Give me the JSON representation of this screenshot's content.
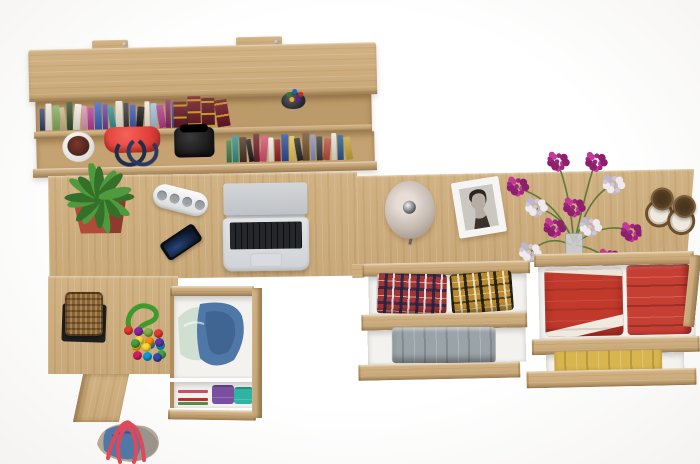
{
  "scene": {
    "type": "product-photo",
    "description": "Top-down view of a light-oak home office set: wall bookshelf with books and bags, corner desk with laptop, phone, plant and power strip, pedestal with open drawer of denim clothes, duffel bag, and a wide chest with four open drawers of folded clothes; lamp, portrait photo, flowers and candle lanterns on top",
    "background": "#fdfdfd"
  },
  "palette": {
    "bg": "#fdfdfd",
    "wood": "#cfae7d",
    "woodLight": "#e0c295",
    "woodDark": "#b08e5c",
    "woodDeep": "#8f6f43",
    "redBag": "#e04038",
    "black": "#161616",
    "pot": "#b14a38",
    "leafGreen": "#4e9a3c",
    "leafDark": "#35702a",
    "stripWhite": "#f2f3f4",
    "phoneBlue": "#27457c",
    "laptopSilver": "#e2e4e7",
    "keyBlack": "#1a1b1f",
    "lampShade": "#c6bab1",
    "frameWhite": "#f6f5f3",
    "flowerMagenta": "#a2247f",
    "flowerPale": "#cfc6d8",
    "stemGreen": "#5c7a3a",
    "candleWood": "#5f4527",
    "candleWax": "#efe9df",
    "plaidRed": "#a23535",
    "plaidYellow": "#b98a2e",
    "jeans": "#9aa3a8",
    "clothRed": "#c0392b",
    "clothRedStack": "#c63f33",
    "clothYellow": "#d8b54e",
    "denim": "#4f77a8",
    "denimDark": "#35577f",
    "mint": "#cfe0d2",
    "purpleShirt": "#7b4fa0",
    "tealShirt": "#2fb3a3",
    "basket": "#8a6335",
    "mat": "#1f1f1f",
    "toyGreen": "#3f9a2e",
    "strapRed": "#e0485a",
    "duffelTan": "#b7a995",
    "duffelGray": "#9a958c"
  },
  "wall_shelf": {
    "material": "light oak wall bookshelf with two mounting brackets",
    "upper_row_spines": [
      "#2e3f74",
      "#ece8dd",
      "#7fae5c",
      "#c8b48a",
      "#31502f",
      "#f0ecdf",
      "#d892b4",
      "#b23a9e",
      "#3a63b8",
      "#6a3f9e",
      "#2f8f8f",
      "#e9e4d8",
      "#353535",
      "#3e57ae",
      "#171717",
      "#efeadf",
      "#9fc0dc",
      "#b03a88",
      "#842a64",
      "#474a8e",
      "#ded6c4",
      "#232323"
    ],
    "encyclopedia_colors": [
      "#6b1822",
      "#731b26",
      "#641520",
      "#6e1722"
    ],
    "lower_row_spines": [
      "#3f7a4c",
      "#2f8f86",
      "#4a3322",
      "#1c1c1c",
      "#6e1d2c",
      "#d2506e",
      "#efeade",
      "#8c1f1f",
      "#2c4c96",
      "#e2c44e",
      "#262626",
      "#6e4e2c",
      "#8a8fb8",
      "#3a3a3a",
      "#b84a3a",
      "#e8e2d4",
      "#2a5a8a",
      "#c8a23a"
    ],
    "pencil_cup_pens": [
      "#2e7d32",
      "#1565c0",
      "#c62828",
      "#f9a825",
      "#6a1b9a"
    ],
    "lower_row_items": [
      "white plant bowl",
      "red handbag",
      "black camera bag",
      "books"
    ]
  },
  "desk": {
    "items": [
      "potted plant in terracotta cube",
      "white power strip",
      "smartphone",
      "open silver laptop"
    ],
    "laptop": {
      "wallpaper": "purple-pink aurora",
      "keys": "black chiclet",
      "trackpad": "silver"
    }
  },
  "pedestal": {
    "drawer_contents": "denim clothes with mint cloth",
    "shelf_contents": [
      "stacked magazines",
      "purple folded shirt",
      "teal folded shirt"
    ],
    "magazine_stripes": [
      "#d04a6a",
      "#f5f2ea",
      "#b83030",
      "#5a8a4a"
    ]
  },
  "accessories": {
    "basket": "wicker basket on black mat",
    "toy": "green rope toy with multicolor pom-poms",
    "toy_pom_colors": [
      "#e53935",
      "#fdd835",
      "#1e88e5",
      "#43a047",
      "#8e24aa",
      "#fb8c00",
      "#00acc1",
      "#d81b60",
      "#7cb342",
      "#5e35b1",
      "#ffb300",
      "#039be5",
      "#e53935",
      "#43a047",
      "#fdd835",
      "#3949ab"
    ],
    "duffel": "denim duffel bag with red straps and tan panels"
  },
  "dresser": {
    "top_items": [
      "round table lamp",
      "white portrait photo frame",
      "magenta and pale flower bouquet in glass vase",
      "two wooden candle lanterns"
    ],
    "drawers": [
      {
        "position": "left-top",
        "contents": "two folded plaid shirts",
        "colors": [
          "#a23535",
          "#b98a2e"
        ]
      },
      {
        "position": "left-bottom",
        "contents": "folded gray jeans",
        "colors": [
          "#9aa3a8"
        ]
      },
      {
        "position": "right-top",
        "contents": "red skirt with white trim and folded red clothes",
        "colors": [
          "#c0392b",
          "#c63f33"
        ]
      },
      {
        "position": "right-bottom",
        "contents": "folded yellow garment",
        "colors": [
          "#d8b54e"
        ]
      }
    ]
  }
}
